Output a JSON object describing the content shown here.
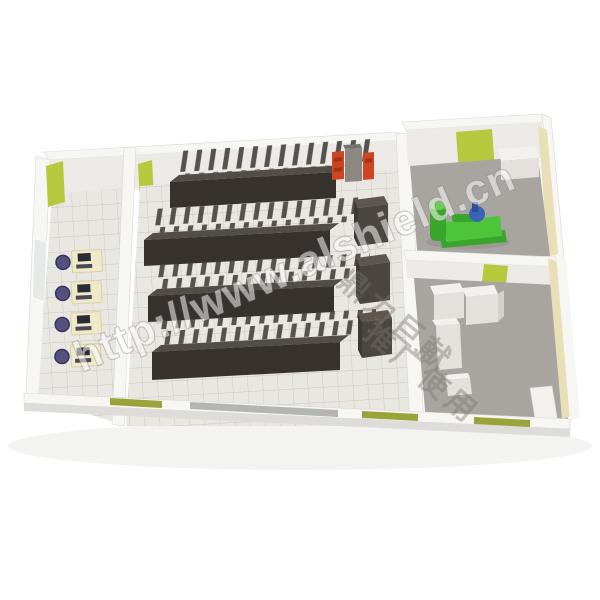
{
  "meta": {
    "description": "3D isometric cutaway render of a machine room floor plan",
    "background": "#ffffff"
  },
  "watermark": {
    "url_text": "http://www.alshield.cn",
    "cn_line_1": "鼎力巨献",
    "cn_line_2": "推广使用"
  },
  "palette": {
    "bg": "#ffffff",
    "wall_white": "#f6f6f3",
    "wall_face": "#ebeae6",
    "wall_shade": "#dddcd8",
    "floor_tile": "#e9e7e1",
    "floor_grid": "#c2bfb6",
    "floor_concrete": "#a8a5a0",
    "accent_green": "#b6c83e",
    "accent_olive": "#9aa23a",
    "tan_wall": "#e9dfb6",
    "rack_front": "#37322e",
    "rack_top": "#534d47",
    "rack_fin": "#4a443f",
    "crac_front": "#4c4641",
    "crac_top": "#5d5750",
    "crac_side": "#3e3934",
    "red_cabinet": "#cf4522",
    "red_cabinet_dark": "#a33318",
    "gray_cabinet": "#8b8883",
    "desk": "#efe8c9",
    "desk_edge": "#d9d0a9",
    "chair": "#53527f",
    "chair_dark": "#35345c",
    "monitor": "#2a2c35",
    "machine_green": "#4ec43a",
    "machine_green_dark": "#3aa52c",
    "machine_green_light": "#6ccc55",
    "machine_blue": "#3a62b5",
    "equipment_white": "#f2f1ed",
    "equipment_white_shade": "#e2e1dc",
    "glass": "#b4b5b1",
    "window_glass": "#e6e9e7",
    "shadow": "#ebebe9"
  },
  "scene": {
    "rooms": [
      {
        "id": "office",
        "desks": 4,
        "chairs": 4,
        "monitors": 4,
        "window": true,
        "green_wall_panels": 1
      },
      {
        "id": "server-hall",
        "rack_rows": 4,
        "crac_units": 3,
        "red_cabinets": 2,
        "gray_cabinets": 1,
        "green_wall_panels": 1
      },
      {
        "id": "generator-room",
        "generators": 1,
        "green_wall_panels": 1
      },
      {
        "id": "ups-room",
        "white_cabinets": 4,
        "green_wall_panels": 1
      }
    ]
  }
}
